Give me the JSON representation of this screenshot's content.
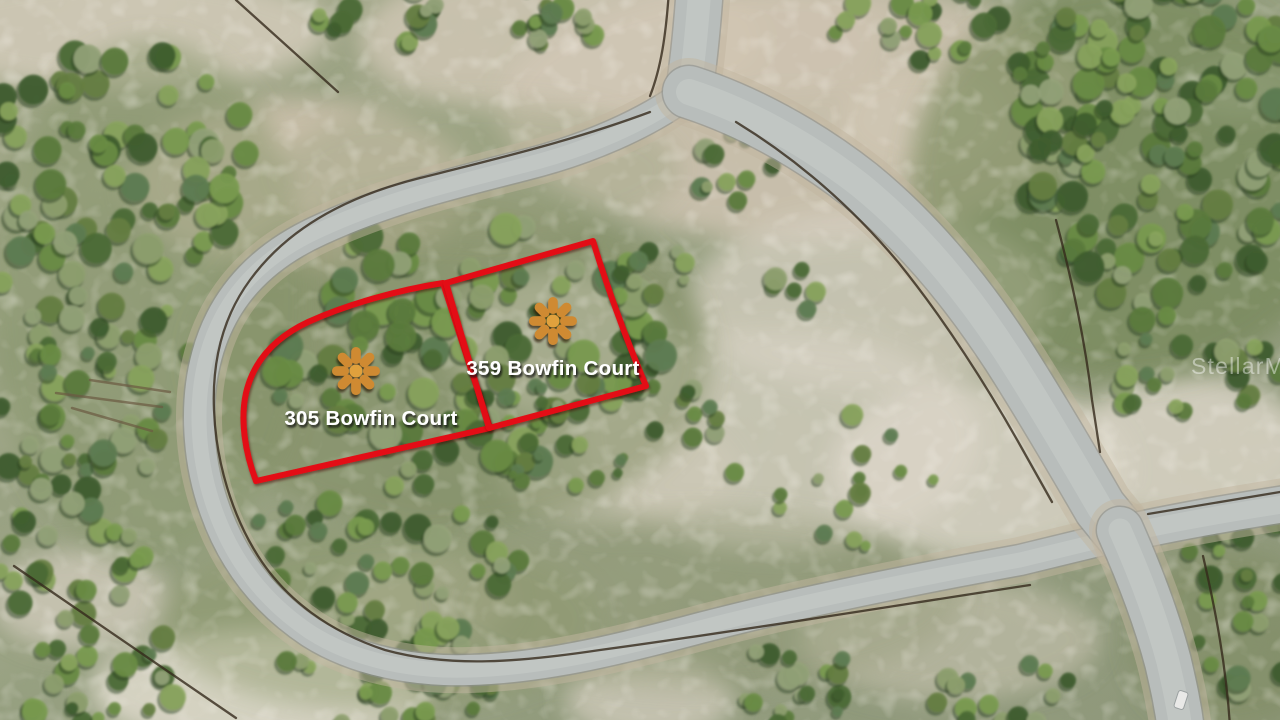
{
  "scene": {
    "description": "Aerial drone photo of vacant land lots outlined in red on a looping residential street",
    "canvas": {
      "width": 1280,
      "height": 720
    },
    "colors": {
      "lot_outline": "#e31112",
      "marker": "#cf8a33",
      "marker_center": "#e0a13e",
      "label_text": "#ffffff",
      "road_asphalt": "#b8bdbb",
      "road_center": "#c9cdca",
      "road_edge": "#8a908e",
      "road_shoulder": "#c2b6a0",
      "fence": "#34291b",
      "tree_shadow": "#2c4124",
      "car": "#e9e9e7"
    },
    "watermark": {
      "text": "StellarMLS",
      "x": 1191,
      "y": 374
    },
    "lots": [
      {
        "label": "305 Bowfin Court",
        "label_x": 371,
        "label_y": 425,
        "marker_x": 356,
        "marker_y": 371,
        "path": "M 443,283 C 398,290 348,304 308,322 C 272,339 253,363 246,393 C 240,420 245,452 256,481 L 490,428 Z"
      },
      {
        "label": "359 Bowfin Court",
        "label_x": 553,
        "label_y": 375,
        "marker_x": 553,
        "marker_y": 321,
        "path": "M 446,283 L 593,241 C 608,290 628,343 646,386 L 489,428 Z"
      }
    ],
    "roads": [
      {
        "name": "street-north-stub",
        "path": "M 700,-14 C 697,30 694,60 689,92",
        "w": 46
      },
      {
        "name": "bowfin-court-loop",
        "path": "M 689,92 C 645,125 585,150 525,165 C 450,184 385,200 320,230 C 258,258 222,300 207,355 C 194,402 197,460 215,510 C 232,558 262,600 310,632 C 355,661 415,672 470,670 C 540,668 610,652 700,628 C 800,602 910,580 1020,560 L 1123,535",
        "w": 30
      },
      {
        "name": "street-northeast-diagonal",
        "path": "M 689,92 C 745,110 805,142 860,185 C 918,232 967,292 1008,355 C 1042,408 1078,470 1100,508 L 1126,540",
        "w": 52
      },
      {
        "name": "street-east",
        "path": "M 1118,535 C 1165,524 1220,514 1292,503",
        "w": 36
      },
      {
        "name": "street-south",
        "path": "M 1120,530 C 1140,575 1157,620 1168,662 C 1174,688 1178,706 1181,730",
        "w": 46
      }
    ],
    "fences": [
      "M 669,-10 C 666,35 661,68 650,96",
      "M 650,112 C 575,140 500,158 420,178 C 340,198 285,232 250,280 C 222,318 212,362 214,410 C 216,462 232,515 258,556 C 286,600 330,632 385,650 C 450,668 520,662 600,650 C 720,634 880,608 1030,585",
      "M 736,122 C 795,158 850,205 898,262 C 945,320 988,388 1020,445 L 1052,502",
      "M 1148,514 L 1292,490",
      "M 1203,556 C 1216,612 1226,666 1230,726",
      "M 14,566 L 236,718",
      "M 236,0 L 338,92",
      "M 1056,220 C 1072,280 1085,340 1092,400 L 1100,452"
    ],
    "logs": [
      "M 56,393 L 162,407",
      "M 72,408 L 152,431",
      "M 90,380 L 170,392"
    ],
    "sand_patches": [
      {
        "cx": 800,
        "cy": 110,
        "rx": 300,
        "ry": 130,
        "fill": "#cfc3b1",
        "op": 0.85
      },
      {
        "cx": 560,
        "cy": 40,
        "rx": 200,
        "ry": 80,
        "fill": "#d2c8b6",
        "op": 0.8
      },
      {
        "cx": 300,
        "cy": 185,
        "rx": 170,
        "ry": 85,
        "fill": "#cfc2ae",
        "op": 0.85
      },
      {
        "cx": 120,
        "cy": 30,
        "rx": 210,
        "ry": 60,
        "fill": "#d6cdbd",
        "op": 0.8
      },
      {
        "cx": 790,
        "cy": 42,
        "rx": 95,
        "ry": 55,
        "fill": "#d0c5b2",
        "op": 0.7
      },
      {
        "cx": 920,
        "cy": 120,
        "rx": 80,
        "ry": 50,
        "fill": "#d3c9b8",
        "op": 0.6
      },
      {
        "cx": 870,
        "cy": 300,
        "rx": 180,
        "ry": 90,
        "fill": "#d8d2c4",
        "op": 0.7
      },
      {
        "cx": 780,
        "cy": 440,
        "rx": 200,
        "ry": 110,
        "fill": "#d6d0c2",
        "op": 0.75
      },
      {
        "cx": 980,
        "cy": 470,
        "rx": 150,
        "ry": 90,
        "fill": "#dcd6c9",
        "op": 0.8
      },
      {
        "cx": 560,
        "cy": 345,
        "rx": 110,
        "ry": 75,
        "fill": "#ddd8cb",
        "op": 0.8
      },
      {
        "cx": 620,
        "cy": 470,
        "rx": 120,
        "ry": 60,
        "fill": "#cfc9b8",
        "op": 0.6
      },
      {
        "cx": 1190,
        "cy": 450,
        "rx": 120,
        "ry": 75,
        "fill": "#d9d3c5",
        "op": 0.85
      },
      {
        "cx": 260,
        "cy": 690,
        "rx": 170,
        "ry": 60,
        "fill": "#dfdacd",
        "op": 0.85
      },
      {
        "cx": 650,
        "cy": 700,
        "rx": 85,
        "ry": 40,
        "fill": "#d8d2c4",
        "op": 0.7
      },
      {
        "cx": 80,
        "cy": 600,
        "rx": 90,
        "ry": 50,
        "fill": "#d5cec0",
        "op": 0.7
      },
      {
        "cx": 950,
        "cy": 640,
        "rx": 150,
        "ry": 60,
        "fill": "#cac4b2",
        "op": 0.6
      },
      {
        "cx": 420,
        "cy": 600,
        "rx": 90,
        "ry": 45,
        "fill": "#cdc6b4",
        "op": 0.5
      },
      {
        "cx": 1240,
        "cy": 90,
        "rx": 60,
        "ry": 28,
        "fill": "#cdd0c2",
        "op": 0.5
      }
    ],
    "green_washes": [
      {
        "cx": 450,
        "cy": 360,
        "rx": 260,
        "ry": 170,
        "fill": "#7c8a5e",
        "op": 0.5
      },
      {
        "cx": 150,
        "cy": 300,
        "rx": 160,
        "ry": 260,
        "fill": "#85936a",
        "op": 0.5
      },
      {
        "cx": 1130,
        "cy": 180,
        "rx": 220,
        "ry": 200,
        "fill": "#6f8352",
        "op": 0.6
      },
      {
        "cx": 380,
        "cy": 620,
        "rx": 220,
        "ry": 90,
        "fill": "#8a9768",
        "op": 0.45
      },
      {
        "cx": 700,
        "cy": 600,
        "rx": 260,
        "ry": 90,
        "fill": "#939c79",
        "op": 0.4
      },
      {
        "cx": 1230,
        "cy": 640,
        "rx": 100,
        "ry": 90,
        "fill": "#7c8a5e",
        "op": 0.5
      },
      {
        "cx": 480,
        "cy": 170,
        "rx": 200,
        "ry": 70,
        "fill": "#9aa37f",
        "op": 0.4
      }
    ],
    "tree_palette": [
      "#3f5e2e",
      "#4c6c36",
      "#5b7c3c",
      "#6b8d45",
      "#7b9c50",
      "#8aa55e",
      "#93a279",
      "#667f42",
      "#5f7d52",
      "#8fa06f"
    ],
    "tree_clusters": [
      {
        "cx": 120,
        "cy": 165,
        "rx": 150,
        "ry": 115,
        "n": 70,
        "rmin": 7,
        "rmax": 16,
        "seed": 3
      },
      {
        "cx": 85,
        "cy": 370,
        "rx": 110,
        "ry": 140,
        "n": 55,
        "rmin": 6,
        "rmax": 14,
        "seed": 5
      },
      {
        "cx": 65,
        "cy": 545,
        "rx": 85,
        "ry": 70,
        "n": 26,
        "rmin": 6,
        "rmax": 13,
        "seed": 7
      },
      {
        "cx": 90,
        "cy": 665,
        "rx": 100,
        "ry": 60,
        "n": 24,
        "rmin": 6,
        "rmax": 13,
        "seed": 47
      },
      {
        "cx": 390,
        "cy": 12,
        "rx": 75,
        "ry": 34,
        "n": 16,
        "rmin": 6,
        "rmax": 13,
        "seed": 9
      },
      {
        "cx": 552,
        "cy": 25,
        "rx": 65,
        "ry": 40,
        "n": 14,
        "rmin": 6,
        "rmax": 12,
        "seed": 11
      },
      {
        "cx": 465,
        "cy": 345,
        "rx": 205,
        "ry": 125,
        "n": 110,
        "rmin": 7,
        "rmax": 17,
        "seed": 13
      },
      {
        "cx": 380,
        "cy": 555,
        "rx": 140,
        "ry": 95,
        "n": 46,
        "rmin": 6,
        "rmax": 14,
        "seed": 15
      },
      {
        "cx": 737,
        "cy": 168,
        "rx": 48,
        "ry": 36,
        "n": 10,
        "rmin": 5,
        "rmax": 11,
        "seed": 17
      },
      {
        "cx": 1165,
        "cy": 140,
        "rx": 150,
        "ry": 170,
        "n": 120,
        "rmin": 7,
        "rmax": 16,
        "seed": 19
      },
      {
        "cx": 920,
        "cy": 25,
        "rx": 90,
        "ry": 40,
        "n": 20,
        "rmin": 6,
        "rmax": 13,
        "seed": 21
      },
      {
        "cx": 1070,
        "cy": 90,
        "rx": 60,
        "ry": 80,
        "n": 22,
        "rmin": 6,
        "rmax": 13,
        "seed": 49
      },
      {
        "cx": 1185,
        "cy": 365,
        "rx": 100,
        "ry": 55,
        "n": 24,
        "rmin": 6,
        "rmax": 13,
        "seed": 23
      },
      {
        "cx": 1245,
        "cy": 600,
        "rx": 70,
        "ry": 95,
        "n": 28,
        "rmin": 6,
        "rmax": 14,
        "seed": 25
      },
      {
        "cx": 1000,
        "cy": 695,
        "rx": 75,
        "ry": 40,
        "n": 14,
        "rmin": 6,
        "rmax": 12,
        "seed": 27
      },
      {
        "cx": 400,
        "cy": 675,
        "rx": 120,
        "ry": 55,
        "n": 30,
        "rmin": 6,
        "rmax": 13,
        "seed": 29
      },
      {
        "cx": 790,
        "cy": 685,
        "rx": 70,
        "ry": 42,
        "n": 18,
        "rmin": 5,
        "rmax": 12,
        "seed": 31
      },
      {
        "cx": 850,
        "cy": 480,
        "rx": 120,
        "ry": 75,
        "n": 16,
        "rmin": 5,
        "rmax": 11,
        "seed": 33
      },
      {
        "cx": 792,
        "cy": 290,
        "rx": 26,
        "ry": 24,
        "n": 6,
        "rmin": 7,
        "rmax": 12,
        "seed": 35
      },
      {
        "cx": 645,
        "cy": 272,
        "rx": 45,
        "ry": 30,
        "n": 9,
        "rmin": 5,
        "rmax": 11,
        "seed": 37
      },
      {
        "cx": 528,
        "cy": 405,
        "rx": 45,
        "ry": 24,
        "n": 8,
        "rmin": 4,
        "rmax": 9,
        "seed": 39
      },
      {
        "cx": 692,
        "cy": 418,
        "rx": 52,
        "ry": 30,
        "n": 9,
        "rmin": 5,
        "rmax": 10,
        "seed": 41
      },
      {
        "cx": 560,
        "cy": 468,
        "rx": 70,
        "ry": 38,
        "n": 10,
        "rmin": 4,
        "rmax": 9,
        "seed": 43
      }
    ],
    "car": {
      "x": 1181,
      "y": 700,
      "angle": 18
    }
  }
}
